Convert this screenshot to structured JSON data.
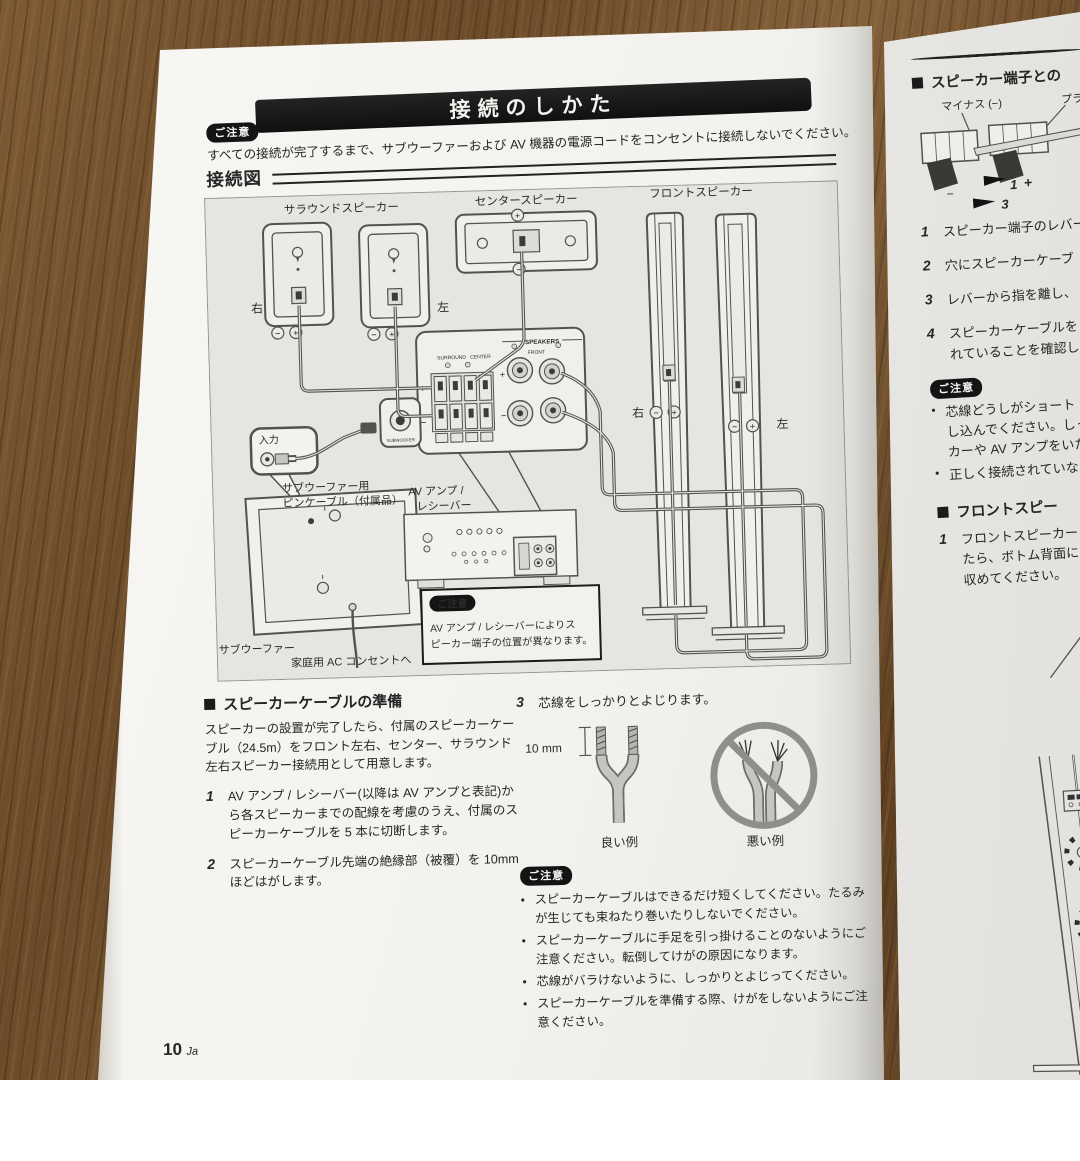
{
  "page_left": {
    "title": "接続のしかた",
    "caution_badge": "ご注意",
    "top_caution": "すべての接続が完了するまで、サブウーファーおよび AV 機器の電源コードをコンセントに接続しないでください。",
    "diagram": {
      "heading": "接続図",
      "surround_label": "サラウンドスピーカー",
      "center_label": "センタースピーカー",
      "front_label": "フロントスピーカー",
      "surround_right": "右",
      "surround_left": "左",
      "front_right": "右",
      "front_left": "左",
      "input_label": "入力",
      "pin_cable_line1": "サブウーファー用",
      "pin_cable_line2": "ピンケーブル（付属品）",
      "av_amp_line1": "AV アンプ /",
      "av_amp_line2": "レシーバー",
      "subwoofer_label": "サブウーファー",
      "ac_label": "家庭用 AC コンセントへ",
      "amp": {
        "speakers": "SPEAKERS",
        "surround": "SURROUND",
        "center": "CENTER",
        "front": "FRONT",
        "subwoofer": "SUBWOOFER"
      },
      "plus": "+",
      "minus": "−",
      "note_badge": "ご注意",
      "note_line1": "AV アンプ / レシーバーによりス",
      "note_line2": "ピーカー端子の位置が異なります。"
    },
    "prep": {
      "heading": "スピーカーケーブルの準備",
      "intro_lines": [
        "スピーカーの設置が完了したら、付属のスピーカーケー",
        "ブル（24.5m）をフロント左右、センター、サラウンド",
        "左右スピーカー接続用として用意します。"
      ],
      "step1_num": "1",
      "step1_lines": [
        "AV アンプ / レシーバー(以降は AV アンプと表記)か",
        "ら各スピーカーまでの配線を考慮のうえ、付属のス",
        "ピーカーケーブルを 5 本に切断します。"
      ],
      "step2_num": "2",
      "step2_lines": [
        "スピーカーケーブル先端の絶縁部（被覆）を 10mm",
        "ほどはがします。"
      ]
    },
    "twist": {
      "step3_num": "3",
      "step3_text": "芯線をしっかりとよじります。",
      "measure": "10 mm",
      "good": "良い例",
      "bad": "悪い例",
      "caution_badge": "ご注意",
      "cautions": [
        {
          "lines": [
            "スピーカーケーブルはできるだけ短くしてください。たるみ",
            "が生じても束ねたり巻いたりしないでください。"
          ]
        },
        {
          "lines": [
            "スピーカーケーブルに手足を引っ掛けることのないようにご",
            "注意ください。転倒してけがの原因になります。"
          ]
        },
        {
          "lines": [
            "芯線がバラけないように、しっかりとよじってください。"
          ]
        },
        {
          "lines": [
            "スピーカーケーブルを準備する際、けがをしないようにご注",
            "意ください。"
          ]
        }
      ]
    },
    "page_number": "10",
    "page_lang": "Ja"
  },
  "page_right": {
    "heading1": "スピーカー端子との",
    "minus_label": "マイナス (−)",
    "plus_label": "プラス",
    "arrow1_num": "1",
    "arrow1_plus": "+",
    "arrow3_num": "3",
    "terminal_minus": "−",
    "steps": [
      {
        "num": "1",
        "line1": "スピーカー端子のレバー",
        "line2": ""
      },
      {
        "num": "2",
        "line1": "穴にスピーカーケーブ",
        "line2": ""
      },
      {
        "num": "3",
        "line1": "レバーから指を離し、",
        "line2": ""
      },
      {
        "num": "4",
        "line1": "スピーカーケーブルを",
        "line2": "れていることを確認し"
      }
    ],
    "caution_badge": "ご注意",
    "caution1_lines": [
      "芯線どうしがショート（接",
      "し込んでください。しっか",
      "カーや AV アンプをいた"
    ],
    "caution2_line": "正しく接続されていない",
    "heading2": "フロントスピー",
    "stepf_num": "1",
    "stepf_lines": [
      "フロントスピーカー",
      "たら、ボトム背面に",
      "収めてください。"
    ]
  }
}
